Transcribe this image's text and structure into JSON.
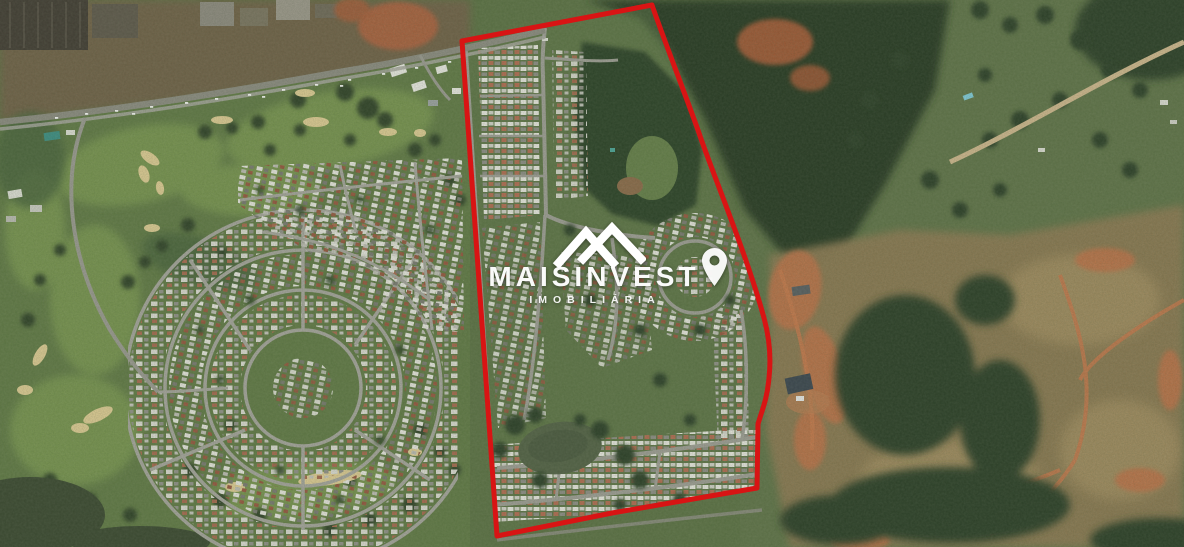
{
  "watermark": {
    "brand": "MAISINVEST",
    "subtitle": "IMOBILIÁRIA",
    "color": "#ffffff",
    "icons": {
      "roof": "roof-chevrons-icon",
      "location": "location-pin-icon"
    }
  },
  "boundary": {
    "label": "property-boundary",
    "color": "#d81414",
    "stroke_width": 5
  },
  "map": {
    "type": "satellite-aerial",
    "palette": {
      "vegetation_dark": "#2c3e26",
      "vegetation_mid": "#5e7547",
      "golf_green": "#74904d",
      "sand_bunker": "#dcc992",
      "pasture_tan": "#8a7751",
      "bare_soil_orange": "#bb7046",
      "road_gray": "#9c9b93",
      "water_dark": "#39462f"
    }
  }
}
